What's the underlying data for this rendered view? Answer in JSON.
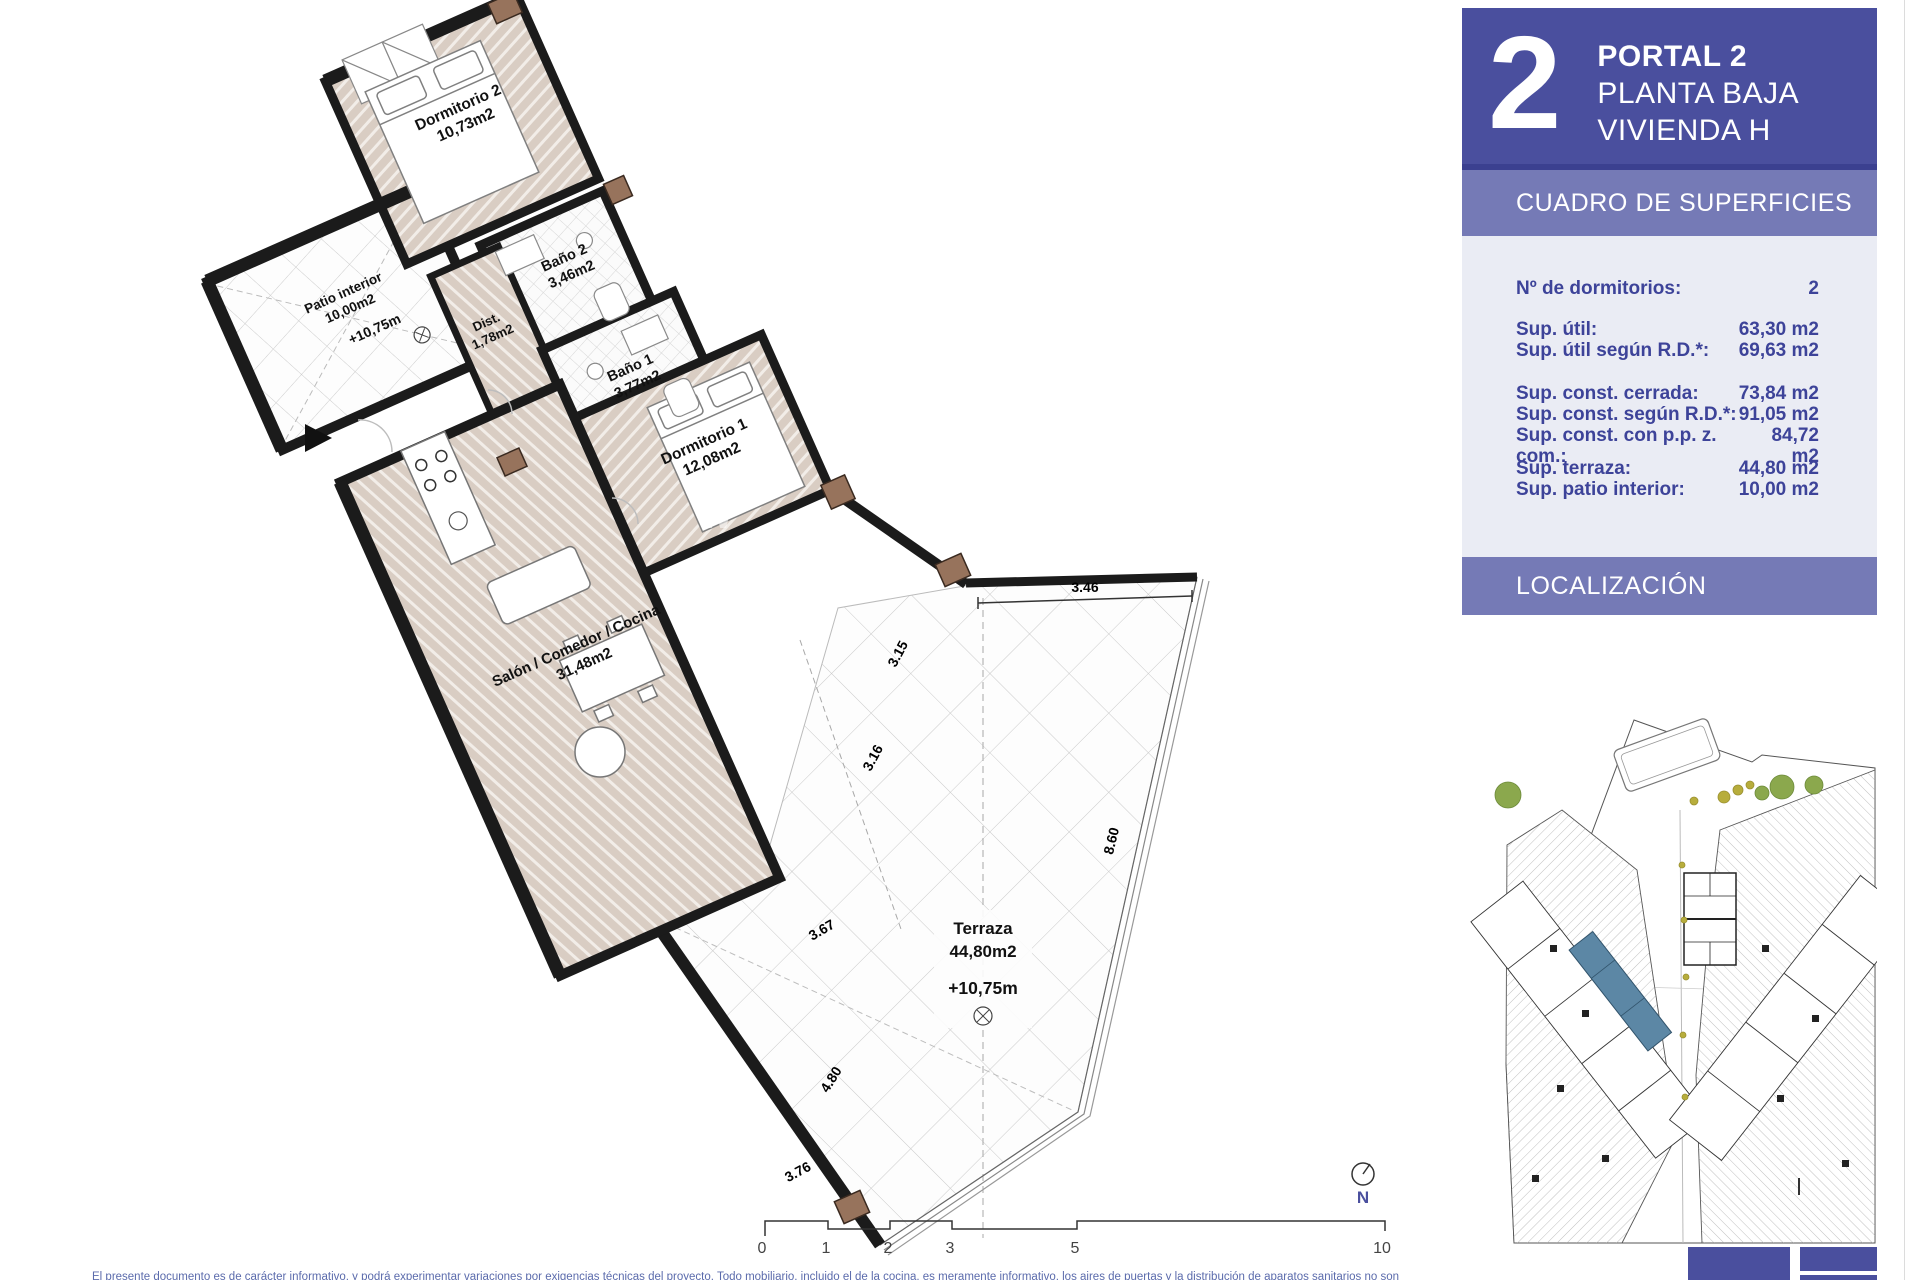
{
  "colors": {
    "accent": "#4a4f9e",
    "band": "#757ab6",
    "table_bg": "#eaecf4",
    "table_text": "#3d4399",
    "highlight_unit": "#5c87a5"
  },
  "sidebar": {
    "unit_number": "2",
    "portal": "PORTAL 2",
    "floor": "PLANTA BAJA",
    "dwelling": "VIVIENDA H",
    "surfaces_title": "CUADRO DE SUPERFICIES",
    "rows": [
      {
        "label": "Nº de dormitorios:",
        "value": "2"
      },
      {
        "label": "Sup. útil:",
        "value": "63,30 m2"
      },
      {
        "label": "Sup. útil según R.D.*:",
        "value": "69,63 m2"
      },
      {
        "label": "Sup. const. cerrada:",
        "value": "73,84 m2"
      },
      {
        "label": "Sup. const. según R.D.*:",
        "value": "91,05 m2"
      },
      {
        "label": "Sup. const. con p.p. z. com.:",
        "value": "84,72 m2"
      },
      {
        "label": "Sup. terraza:",
        "value": "44,80 m2"
      },
      {
        "label": "Sup. patio interior:",
        "value": "10,00 m2"
      }
    ],
    "location_title": "LOCALIZACIÓN"
  },
  "plan": {
    "rooms": [
      {
        "name": "Dormitorio 2",
        "area": "10,73m2"
      },
      {
        "name": "Baño 2",
        "area": "3,46m2"
      },
      {
        "name": "Dist.",
        "area": "1,78m2"
      },
      {
        "name": "Baño 1",
        "area": "3,77m2"
      },
      {
        "name": "Patio interior",
        "area": "10,00m2",
        "level": "+10,75m"
      },
      {
        "name": "Dormitorio 1",
        "area": "12,08m2"
      },
      {
        "name": "Salón / Comedor / Cocina",
        "area": "31,48m2"
      },
      {
        "name": "Terraza",
        "area": "44,80m2",
        "level": "+10,75m"
      }
    ],
    "dimensions": [
      "3.46",
      "3.15",
      "3.16",
      "8.60",
      "3.67",
      "4.80",
      "3.76"
    ],
    "scale": [
      "0",
      "1",
      "2",
      "3",
      "5",
      "10"
    ],
    "north_label": "N",
    "watermark": "W"
  },
  "footer": {
    "disclaimer": "El presente documento es de carácter informativo, y podrá experimentar variaciones por exigencias técnicas del proyecto. Todo mobiliario, incluido el de la cocina, es meramente informativo, los aires de puertas y la distribución de aparatos sanitarios no son"
  }
}
